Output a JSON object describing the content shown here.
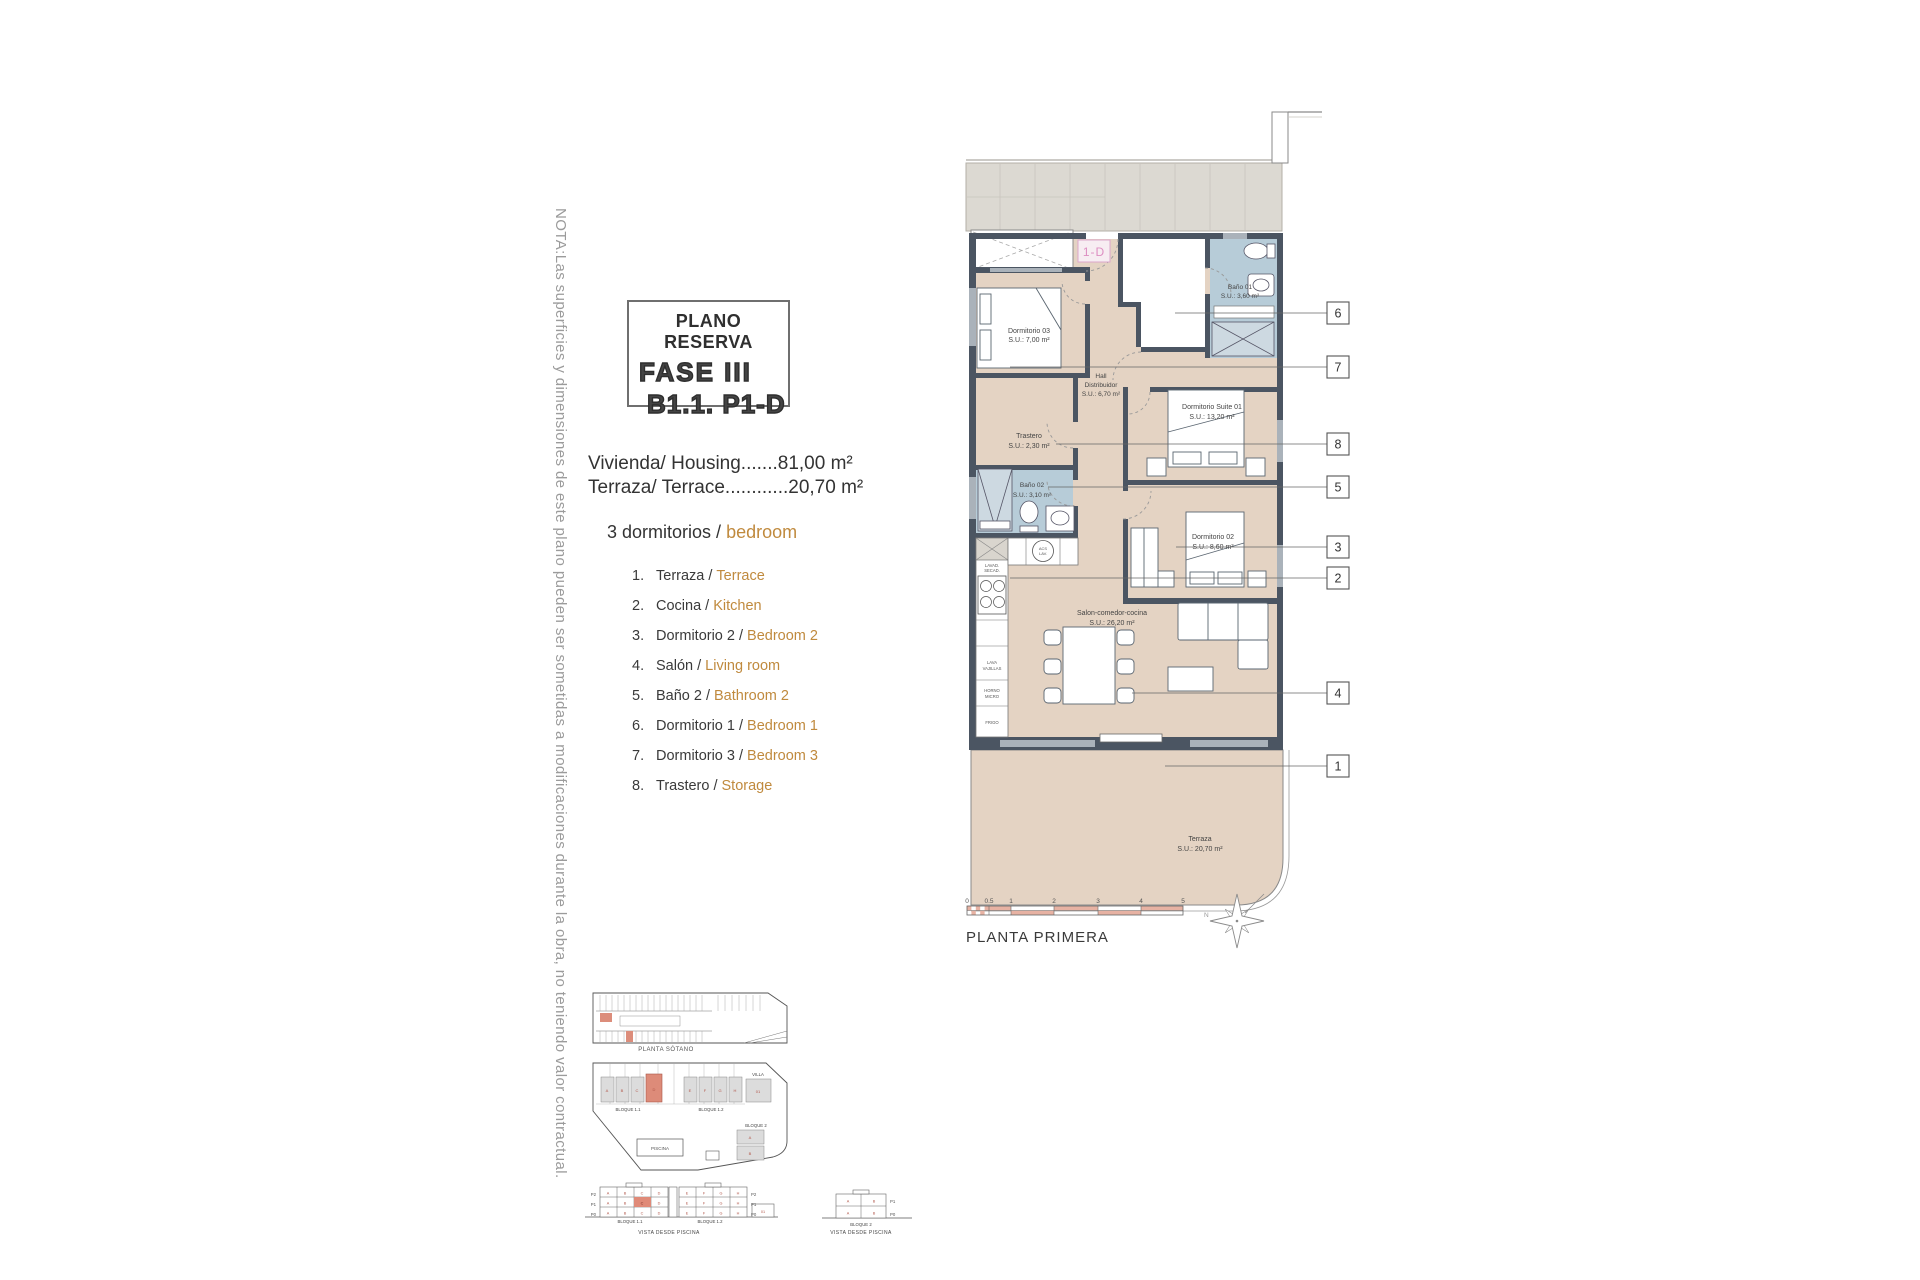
{
  "note": "NOTA:Las superficies y dimensiones de este plano pueden ser sometidas a modificaciones durante la obra, no teniendo valor contractual.",
  "title_box": {
    "line1": "PLANO RESERVA",
    "line2": "FASE III",
    "line3": "B1.1. P1-D"
  },
  "summary": {
    "housing": "Vivienda/ Housing.......81,00 m²",
    "terrace": "Terraza/ Terrace............20,70 m²"
  },
  "heading": {
    "es": "3 dormitorios /",
    "en": "bedroom"
  },
  "legend": [
    {
      "num": "1.",
      "es": "Terraza /",
      "en": "Terrace"
    },
    {
      "num": "2.",
      "es": "Cocina /",
      "en": "Kitchen"
    },
    {
      "num": "3.",
      "es": "Dormitorio 2 /",
      "en": "Bedroom 2"
    },
    {
      "num": "4.",
      "es": "Salón /",
      "en": "Living room"
    },
    {
      "num": "5.",
      "es": "Baño 2 /",
      "en": "Bathroom 2"
    },
    {
      "num": "6.",
      "es": "Dormitorio 1 /",
      "en": "Bedroom 1"
    },
    {
      "num": "7.",
      "es": "Dormitorio 3 /",
      "en": "Bedroom 3"
    },
    {
      "num": "8.",
      "es": "Trastero /",
      "en": "Storage"
    }
  ],
  "plan": {
    "unit": "1-D",
    "floor_label": "PLANTA PRIMERA",
    "compass_n": "N",
    "rooms": {
      "dorm3": {
        "name": "Dormitorio 03",
        "area": "S.U.: 7,00 m²"
      },
      "bath1": {
        "name": "Baño 01",
        "area": "S.U.: 3,60 m²"
      },
      "hall1": "Hall",
      "hall2": "Distribuidor",
      "hall3": "S.U.: 6,70 m²",
      "suite": {
        "name": "Dormitorio Suite 01",
        "area": "S.U.: 13,20 m²"
      },
      "trastero": {
        "name": "Trastero",
        "area": "S.U.: 2,30 m²"
      },
      "bath2": {
        "name": "Baño 02",
        "area": "S.U.: 3,10 m²"
      },
      "dorm2": {
        "name": "Dormitorio 02",
        "area": "S.U.: 8,60 m²"
      },
      "salon": {
        "name": "Salon-comedor-cocina",
        "area": "S.U.: 26,20 m²"
      },
      "terraza": {
        "name": "Terraza",
        "area": "S.U.: 20,70 m²"
      }
    },
    "appliances": {
      "washer1": "LAVAD.",
      "washer2": "SECAD.",
      "acs1": "ACS",
      "acs2": "LAV.",
      "dish1": "LAVA",
      "dish2": "VAJILLAS",
      "oven1": "HORNO",
      "oven2": "MICRO",
      "fridge": "FRIGO"
    },
    "callouts": {
      "c6": "6",
      "c7": "7",
      "c8": "8",
      "c5": "5",
      "c3": "3",
      "c2": "2",
      "c4": "4",
      "c1": "1"
    },
    "scale": {
      "t0": "0",
      "t05": "0.5",
      "t1": "1",
      "t2": "2",
      "t3": "3",
      "t4": "4",
      "t5": "5"
    }
  },
  "site": {
    "basement_caption": "PLANTA SÓTANO",
    "block11": "BLOQUE 1.1",
    "block12": "BLOQUE 1.2",
    "block2": "BLOQUE 2",
    "villa": "VILLA",
    "villa_unit": "01",
    "small_unit": "01",
    "pool": "PISCINA",
    "view_caption": "VISTA DESDE PISCINA",
    "floors": {
      "p2": "P2",
      "p1": "P1",
      "p0": "P0"
    },
    "letters": {
      "block11": [
        "A",
        "B",
        "C",
        "D"
      ],
      "block12": [
        "E",
        "F",
        "G",
        "H"
      ],
      "block2": [
        "A",
        "B"
      ]
    }
  },
  "colors": {
    "wall": "#4b5562",
    "room_fill": "#e4d3c3",
    "bath_fill": "#b7ccd8",
    "corridor_fill": "#dcd9d2",
    "accent_tan": "#c08a3e",
    "scale_salmon": "#e7b2a3",
    "highlight_salmon": "#dd8b79",
    "unit_pink": "#dd8ec2"
  }
}
